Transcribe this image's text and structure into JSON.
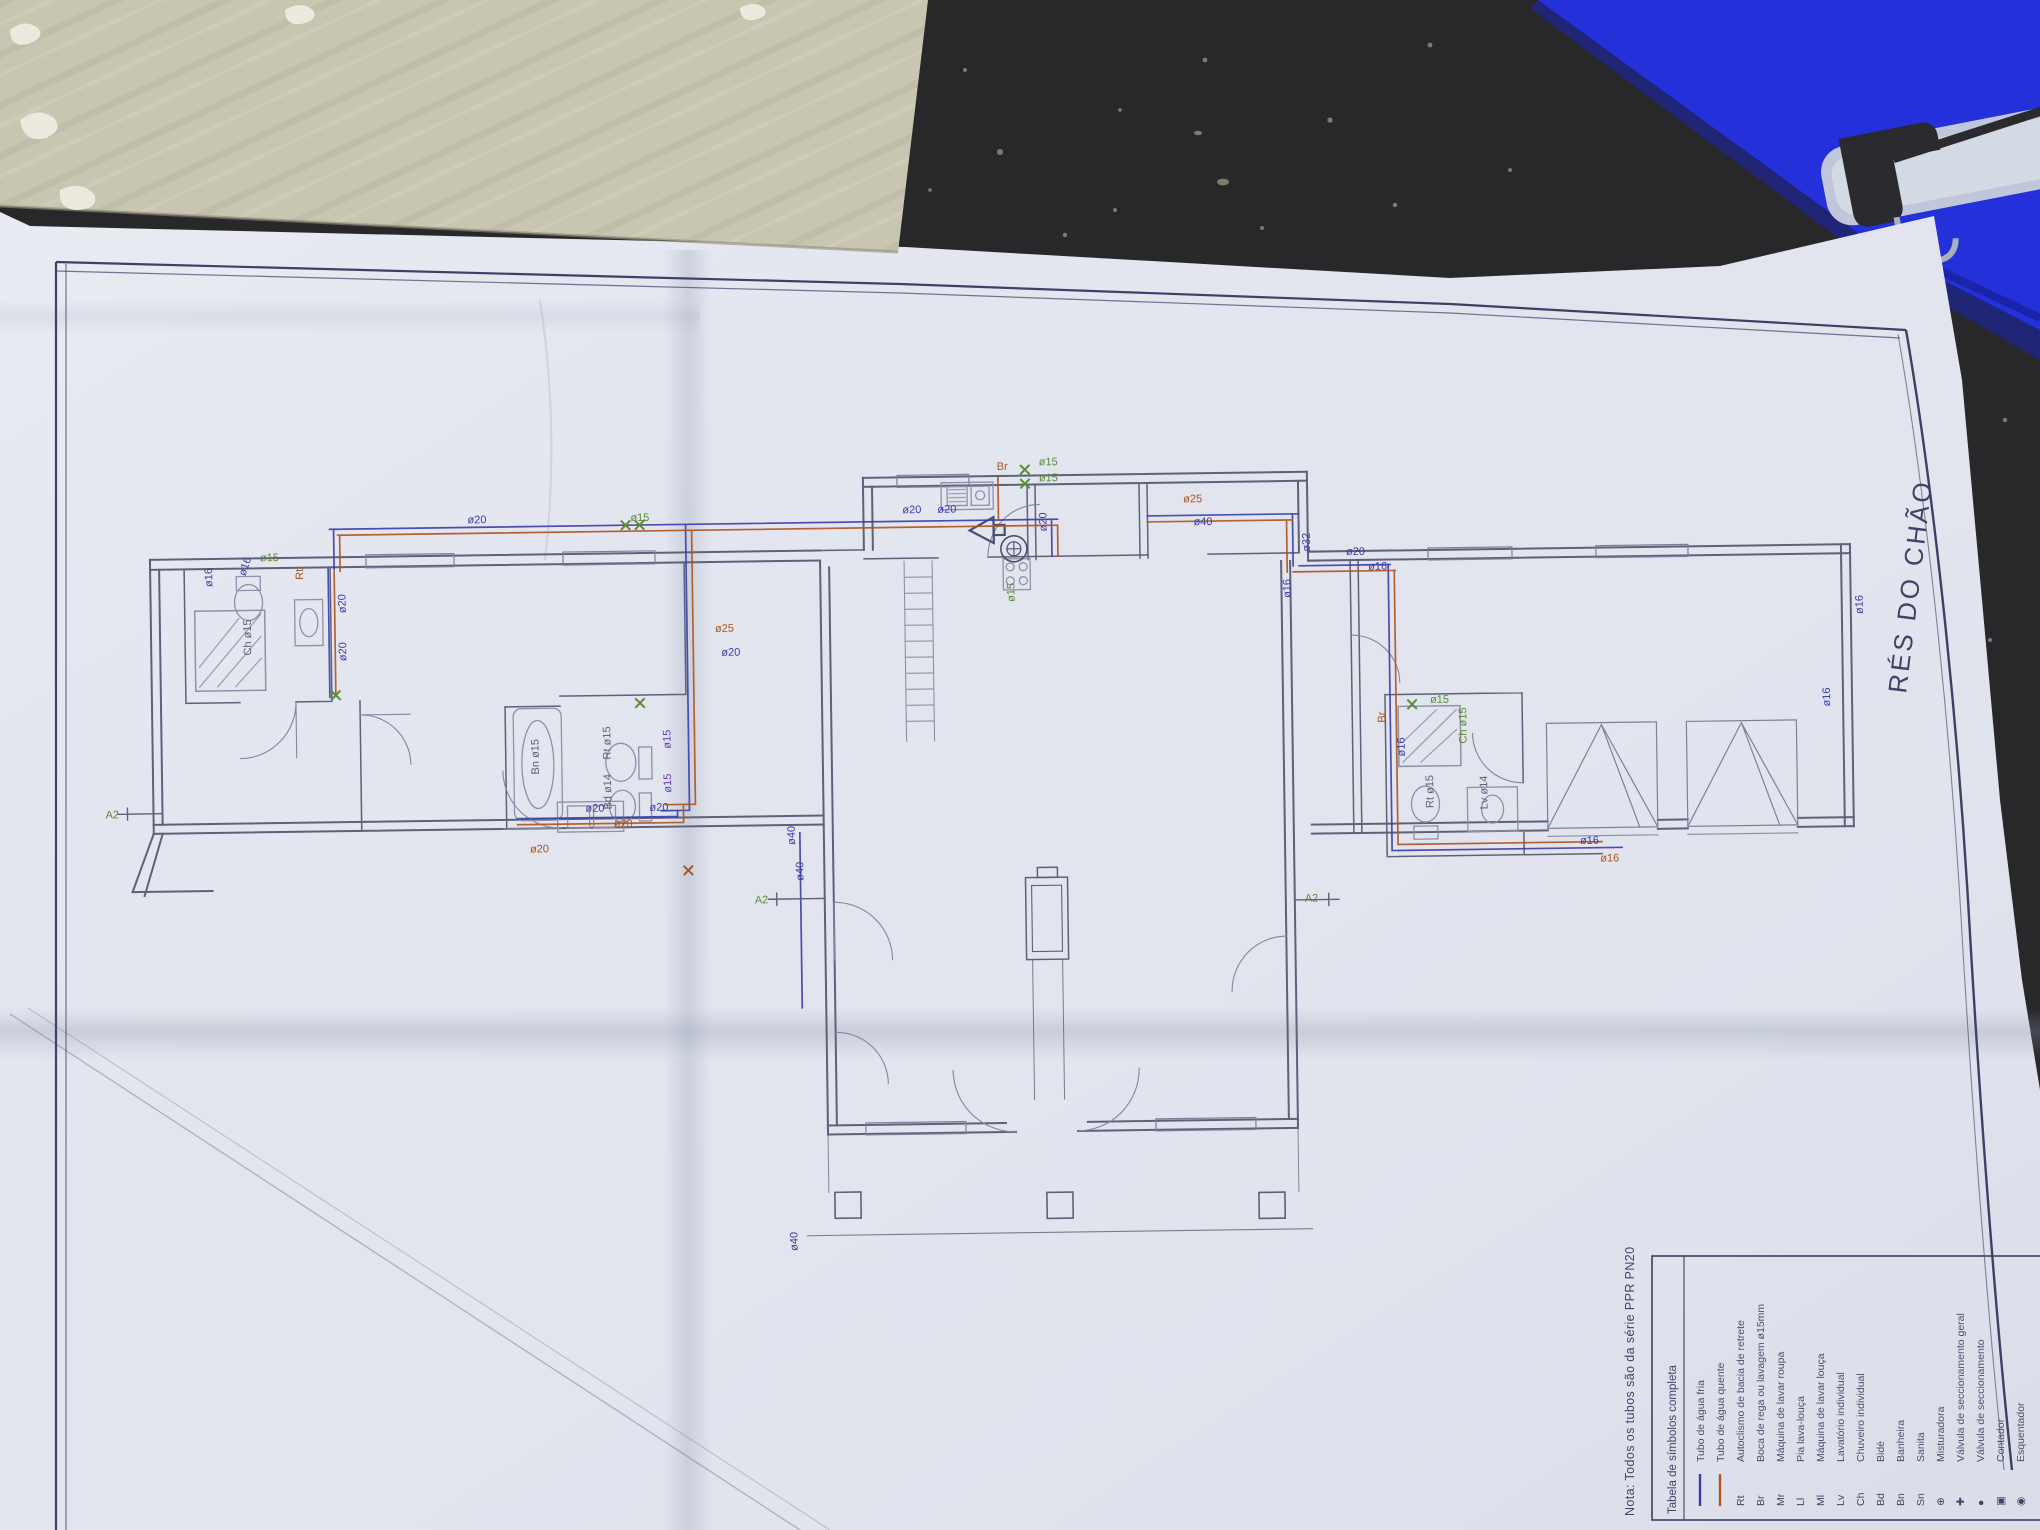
{
  "colors": {
    "table": "#28282b",
    "cardboard": "#c8c5b1",
    "folder_blue": "#2430da",
    "paper": "#e2e5ee",
    "frame_navy": "#3c4166",
    "wall": "#5d6179",
    "furniture": "#8d91a9",
    "cold": "#3a3daa",
    "hot": "#b0531d",
    "green": "#5a8c34",
    "purple": "#6040b0"
  },
  "sheet": {
    "title": "RÉS DO CHÃO",
    "note": "Nota:  Todos os tubos são da série PPR PN20",
    "legend": {
      "title": "Tabela de símbolos completa",
      "rows": [
        {
          "sym": "line",
          "c": "cold",
          "abbr": "",
          "label": "Tubo de água fria"
        },
        {
          "sym": "line",
          "c": "hot",
          "abbr": "",
          "label": "Tubo de água quente"
        },
        {
          "sym": "",
          "c": "wall",
          "abbr": "Rt",
          "label": "Autoclismo de bacia de retrete"
        },
        {
          "sym": "",
          "c": "wall",
          "abbr": "Br",
          "label": "Boca de rega ou lavagem ø15mm"
        },
        {
          "sym": "",
          "c": "wall",
          "abbr": "Mr",
          "label": "Máquina de lavar roupa"
        },
        {
          "sym": "",
          "c": "wall",
          "abbr": "Ll",
          "label": "Pia lava-louça"
        },
        {
          "sym": "",
          "c": "wall",
          "abbr": "Ml",
          "label": "Máquina de lavar louça"
        },
        {
          "sym": "",
          "c": "wall",
          "abbr": "Lv",
          "label": "Lavatório individual"
        },
        {
          "sym": "",
          "c": "wall",
          "abbr": "Ch",
          "label": "Chuveiro individual"
        },
        {
          "sym": "",
          "c": "wall",
          "abbr": "Bd",
          "label": "Bidé"
        },
        {
          "sym": "",
          "c": "wall",
          "abbr": "Bn",
          "label": "Banheira"
        },
        {
          "sym": "",
          "c": "wall",
          "abbr": "Sn",
          "label": "Sanita"
        },
        {
          "sym": "",
          "c": "wall",
          "abbr": "⊕",
          "label": "Misturadora"
        },
        {
          "sym": "",
          "c": "wall",
          "abbr": "✚",
          "label": "Válvula de seccionamento geral"
        },
        {
          "sym": "",
          "c": "wall",
          "abbr": "●",
          "label": "Válvula de seccionamento"
        },
        {
          "sym": "",
          "c": "wall",
          "abbr": "▣",
          "label": "Contador"
        },
        {
          "sym": "",
          "c": "wall",
          "abbr": "◉",
          "label": "Esquentador"
        }
      ]
    },
    "plan_labels": [
      {
        "t": "ø16",
        "x": 214,
        "y": 576,
        "c": "cold",
        "r": -90
      },
      {
        "t": "ø16",
        "x": 247,
        "y": 566,
        "c": "cold",
        "r": -70
      },
      {
        "t": "Rt",
        "x": 305,
        "y": 570,
        "c": "hot",
        "r": -90
      },
      {
        "t": "ø15",
        "x": 262,
        "y": 551,
        "c": "green",
        "r": 0
      },
      {
        "t": "ø20",
        "x": 347,
        "y": 604,
        "c": "cold",
        "r": -90
      },
      {
        "t": "ø20",
        "x": 347,
        "y": 652,
        "c": "cold",
        "r": -90
      },
      {
        "t": "Ch ø15",
        "x": 252,
        "y": 645,
        "c": "wall",
        "r": -90
      },
      {
        "t": "ø20",
        "x": 470,
        "y": 516,
        "c": "cold",
        "r": 0
      },
      {
        "t": "ø15",
        "x": 633,
        "y": 516,
        "c": "green",
        "r": 0
      },
      {
        "t": "ø25",
        "x": 716,
        "y": 628,
        "c": "hot",
        "r": 0
      },
      {
        "t": "ø20",
        "x": 722,
        "y": 652,
        "c": "cold",
        "r": 0
      },
      {
        "t": "ø20",
        "x": 584,
        "y": 806,
        "c": "cold",
        "r": 0
      },
      {
        "t": "ø20",
        "x": 528,
        "y": 846,
        "c": "hot",
        "r": 0
      },
      {
        "t": "ø20",
        "x": 612,
        "y": 822,
        "c": "hot",
        "r": 0
      },
      {
        "t": "ø20",
        "x": 648,
        "y": 806,
        "c": "cold",
        "r": 0
      },
      {
        "t": "ø15",
        "x": 670,
        "y": 744,
        "c": "purple",
        "r": -90
      },
      {
        "t": "ø15",
        "x": 670,
        "y": 788,
        "c": "purple",
        "r": -90
      },
      {
        "t": "Bn ø15",
        "x": 538,
        "y": 768,
        "c": "wall",
        "r": -90
      },
      {
        "t": "Rt ø15",
        "x": 610,
        "y": 754,
        "c": "wall",
        "r": -90
      },
      {
        "t": "Bd ø14",
        "x": 610,
        "y": 804,
        "c": "wall",
        "r": -90
      },
      {
        "t": "ø20",
        "x": 905,
        "y": 512,
        "c": "cold",
        "r": 0
      },
      {
        "t": "ø20",
        "x": 940,
        "y": 512,
        "c": "cold",
        "r": 0
      },
      {
        "t": "Br",
        "x": 1000,
        "y": 470,
        "c": "hot",
        "r": 0
      },
      {
        "t": "ø15",
        "x": 1042,
        "y": 466,
        "c": "green",
        "r": 0
      },
      {
        "t": "ø15",
        "x": 1042,
        "y": 482,
        "c": "green",
        "r": 0
      },
      {
        "t": "ø20",
        "x": 1049,
        "y": 532,
        "c": "cold",
        "r": -90
      },
      {
        "t": "ø15",
        "x": 1016,
        "y": 602,
        "c": "green",
        "r": -90
      },
      {
        "t": "ø25",
        "x": 1186,
        "y": 505,
        "c": "hot",
        "r": 0
      },
      {
        "t": "ø40",
        "x": 1196,
        "y": 528,
        "c": "cold",
        "r": 0
      },
      {
        "t": "ø32",
        "x": 1312,
        "y": 556,
        "c": "cold",
        "r": -90
      },
      {
        "t": "ø16",
        "x": 1292,
        "y": 602,
        "c": "cold",
        "r": -90
      },
      {
        "t": "ø40",
        "x": 793,
        "y": 842,
        "c": "cold",
        "r": -90
      },
      {
        "t": "ø40",
        "x": 801,
        "y": 878,
        "c": "cold",
        "r": -90
      },
      {
        "t": "A2",
        "x": 752,
        "y": 900,
        "c": "green",
        "r": 0
      },
      {
        "t": "A2",
        "x": 1302,
        "y": 906,
        "c": "green",
        "r": 0
      },
      {
        "t": "A2",
        "x": 104,
        "y": 806,
        "c": "green",
        "r": 0
      },
      {
        "t": "ø40",
        "x": 790,
        "y": 1248,
        "c": "cold",
        "r": -90
      },
      {
        "t": "ø20",
        "x": 1348,
        "y": 560,
        "c": "cold",
        "r": 0
      },
      {
        "t": "ø16",
        "x": 1370,
        "y": 575,
        "c": "cold",
        "r": 0
      },
      {
        "t": "Br",
        "x": 1385,
        "y": 728,
        "c": "hot",
        "r": -90
      },
      {
        "t": "ø15",
        "x": 1430,
        "y": 709,
        "c": "green",
        "r": 0
      },
      {
        "t": "ø16",
        "x": 1404,
        "y": 762,
        "c": "cold",
        "r": -90
      },
      {
        "t": "Ch ø15",
        "x": 1466,
        "y": 750,
        "c": "green",
        "r": -90
      },
      {
        "t": "Rt ø15",
        "x": 1432,
        "y": 814,
        "c": "wall",
        "r": -90
      },
      {
        "t": "Lv ø14",
        "x": 1486,
        "y": 816,
        "c": "wall",
        "r": -90
      },
      {
        "t": "ø16",
        "x": 1578,
        "y": 852,
        "c": "cold",
        "r": 0
      },
      {
        "t": "ø16",
        "x": 1598,
        "y": 870,
        "c": "hot",
        "r": 0
      },
      {
        "t": "ø16",
        "x": 1830,
        "y": 718,
        "c": "cold",
        "r": -90
      },
      {
        "t": "ø16",
        "x": 1864,
        "y": 626,
        "c": "cold",
        "r": -90
      }
    ]
  }
}
